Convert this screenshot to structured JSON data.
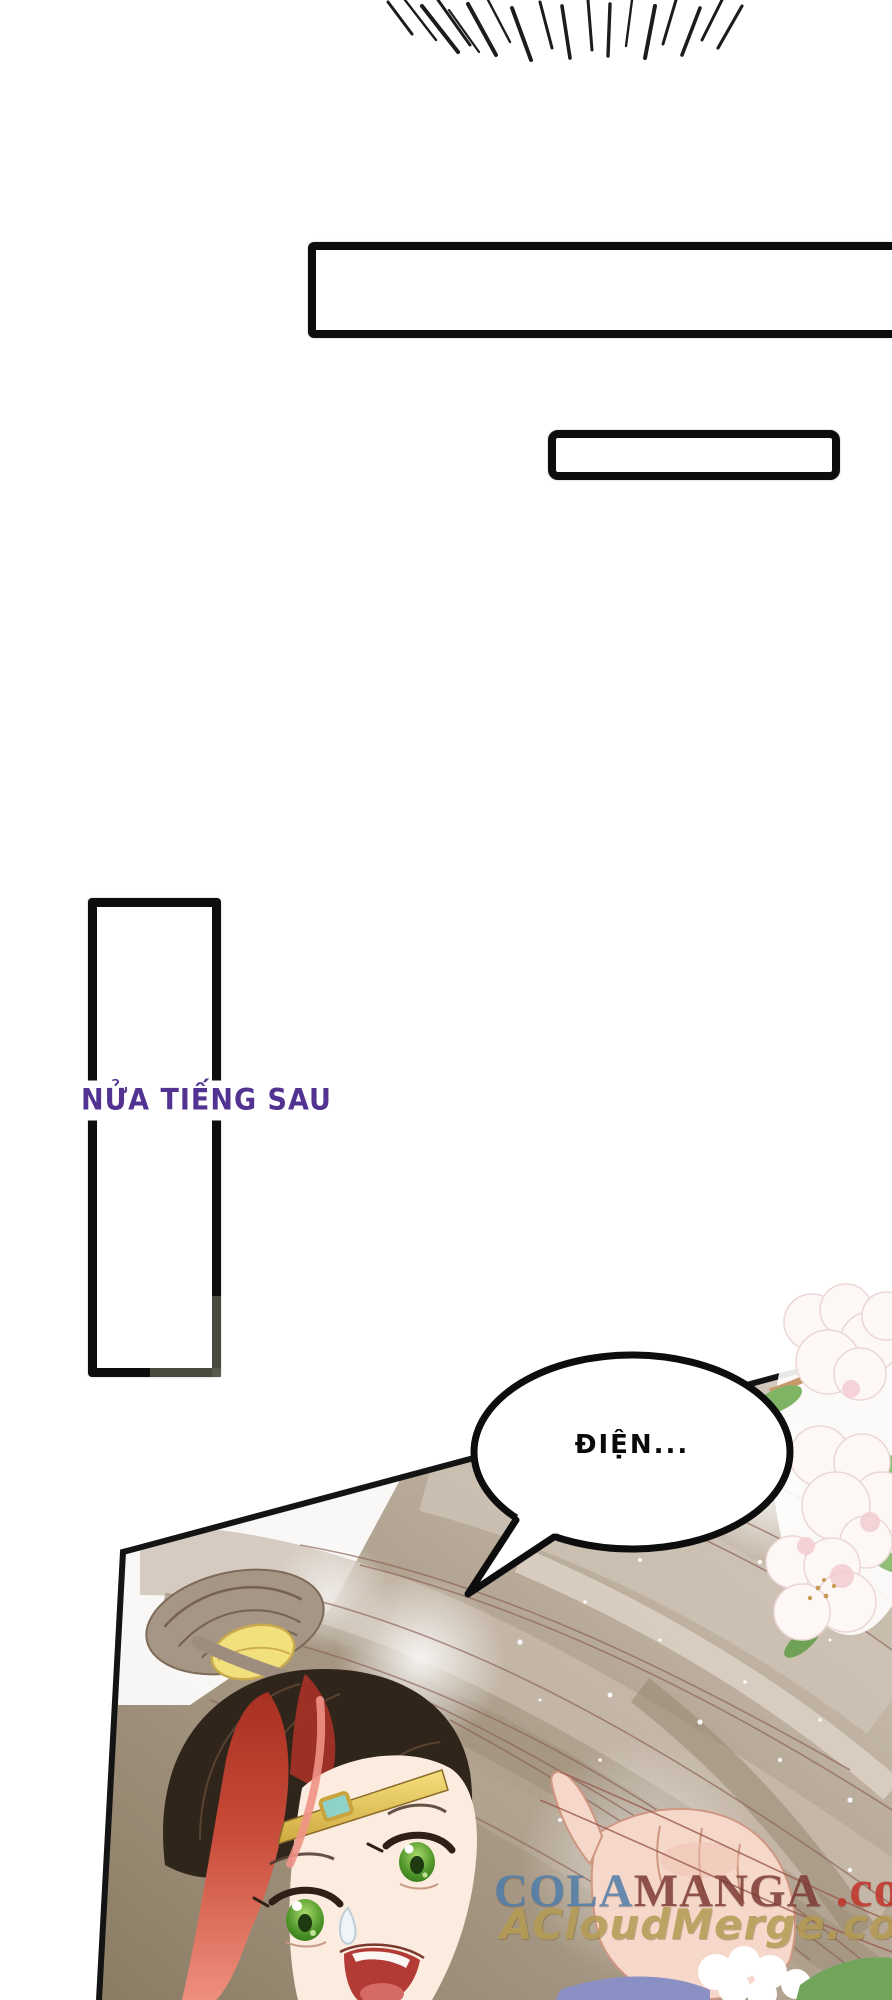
{
  "page": {
    "background": "#ffffff",
    "type": "manga-page"
  },
  "caption": {
    "text": "NỬA TIẾNG SAU",
    "color": "#523391"
  },
  "speech_bubble": {
    "text": "ĐIỆN...",
    "fill": "#ffffff",
    "stroke": "#0d0d0d"
  },
  "narration_boxes": {
    "wide_box_text": "",
    "small_box_text": "",
    "vertical_box_text": ""
  },
  "watermark": {
    "site1": {
      "part1": "COLA",
      "part2": "MANGA",
      "part3": ".com",
      "part1_color": "#4e7ca8",
      "part2_color": "#7b3a33",
      "part3_color": "#c13227"
    },
    "site2": {
      "text": "ACloudMerge.com",
      "color": "#b49a52"
    }
  },
  "palette": {
    "panel_background": "#9a8c78",
    "hair_taupe": "#b5a795",
    "hair_dark": "#30251b",
    "hair_red_streak": "#c0453a",
    "hair_pink_tip": "#ef8d7e",
    "eye_green": "#55a036",
    "headband_gold": "#e8c95c",
    "gem_teal": "#8fd2ca",
    "skin": "#fcebdf",
    "hand_skin": "#f6d8cb",
    "cloth_purple": "#8b90c4",
    "leaf_green": "#7fb465",
    "flower_white": "#fdf7f5"
  }
}
